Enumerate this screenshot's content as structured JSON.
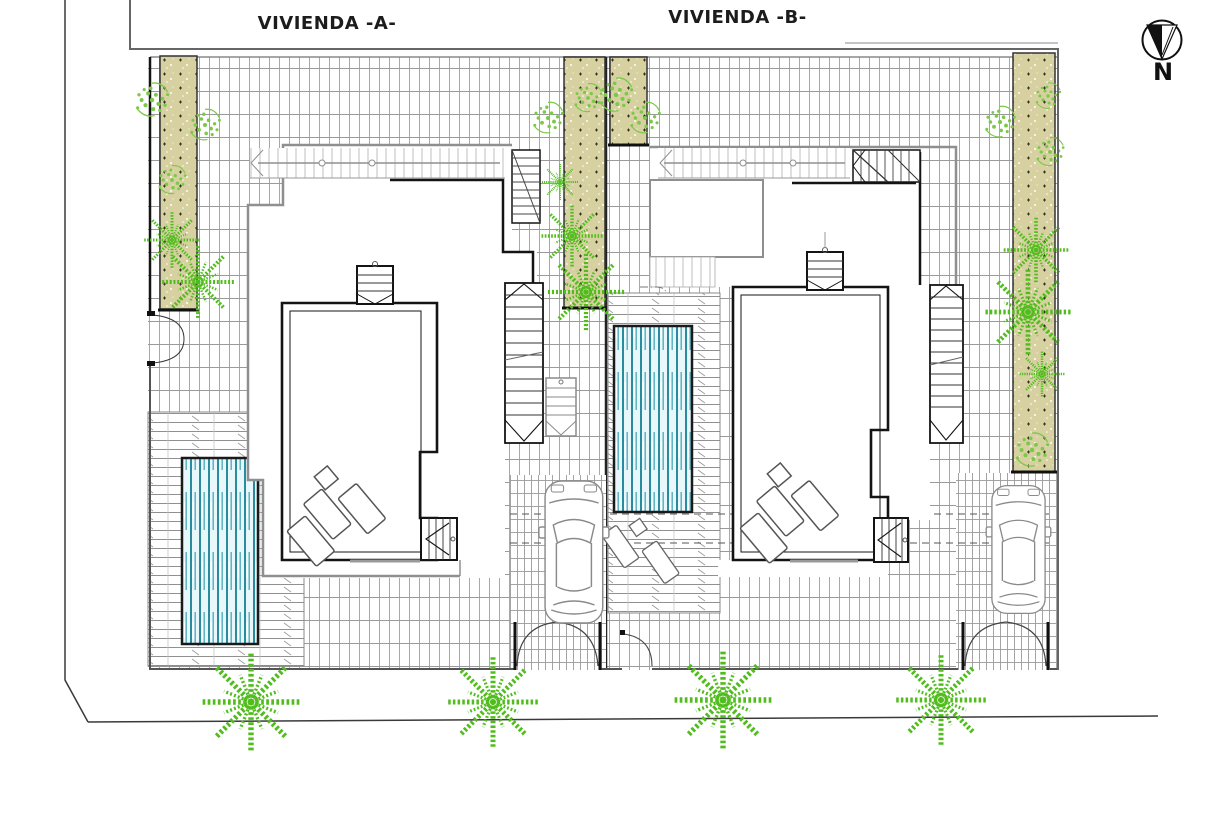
{
  "titles": {
    "villa_a": "VIVIENDA -A-",
    "villa_b": "VIVIENDA -B-"
  },
  "compass": {
    "label": "N"
  },
  "colors": {
    "paper": "#ffffff",
    "tile_line": "#9a9a9a",
    "deck_line": "#909090",
    "pool_stripe": "#2a8b9e",
    "pool_background": "#e8f7fa",
    "hedge_fill": "#d7d1a1",
    "plant_green": "#50bd1d",
    "shrub_green": "#7cc84a",
    "wall_black": "#141414",
    "overhang_gray": "#8f8f8f",
    "boundary": "#3a3a3a"
  }
}
